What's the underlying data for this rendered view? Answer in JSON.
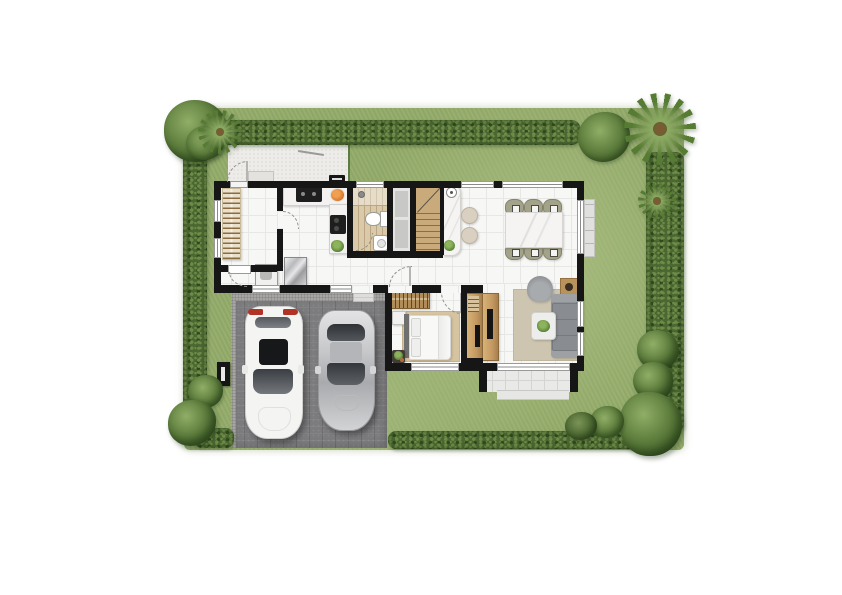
{
  "meta": {
    "type": "architectural site / floor plan, top-down render",
    "visible_text": [],
    "description": "Single-storey house plan on a lawned plot bordered by hedges and trees; back patio top-left, carport with two cars bottom-left, terrace with step bottom-right."
  },
  "palette": {
    "lawn": "#93ab6a",
    "lawn_light": "#a9bd80",
    "hedge": "#4c6832",
    "hedge_light": "#6e8c48",
    "hedge_dark": "#31491d",
    "tree": "#5d7d3d",
    "tree_light": "#90ae66",
    "tree_dark": "#3c5a26",
    "palm": "#567b33",
    "palm_dark": "#7a5c33",
    "wall": "#161616",
    "floor": "#f7f7f6",
    "tile": "#e7e7e5",
    "wood_floor": "#dbcaa9",
    "stair_wood": "#c9aa7b",
    "stair_tread": "#8a6d45",
    "patio": "#edece8",
    "terrace": "#e9e9e7",
    "terrace_line": "#d4d4d2",
    "driveway": "#7c7c7e",
    "gravel": "#a6a5a3",
    "counter": "#f3f2f0",
    "appliance": "#1e1e1e",
    "cabinet_wood": "#c49a62",
    "wardrobe": "#b08c58",
    "tv": "#141414",
    "chair_olive": "#a2a389",
    "stool": "#d9d0c1",
    "sofa": "#8f9296",
    "sofa_dark": "#7c8084",
    "rug_living": "#cdc5b0",
    "rug_bed": "#d6c3a0",
    "bed": "#f8f8f7",
    "headboard": "#6f6f6f",
    "plant": "#5f8b3f",
    "pot": "#b06a42",
    "fruit": "#d8742c",
    "car_white": "#f4f4f3",
    "car_red": "#b33226",
    "car_silver": "#c6c7c9",
    "glass": "#3a3e43",
    "window": "#ffffff",
    "sill": "#e0e0de",
    "marble_table": "#f5f4f2"
  },
  "scene": {
    "plot": {
      "ground": "lawn",
      "boundaries": [
        "hedge-top",
        "hedge-left",
        "hedge-right",
        "hedge-bottom"
      ],
      "hardscape": [
        "back-patio-concrete",
        "carport-paver-driveway",
        "terrace-with-step"
      ],
      "vegetation": [
        "corner-tree-top-left",
        "palm-top-left",
        "bush-top-right",
        "palm-top-right-corner",
        "palm-right-side",
        "round-tree-right",
        "tree-right-lower",
        "large-tree-bottom-right",
        "bush-bottom-right",
        "dark-bush-bottom-right",
        "bush-bottom-left",
        "large-bush-bottom-left"
      ]
    },
    "house": {
      "rooms": [
        {
          "name": "utility-room",
          "furniture": [
            "slatted-shelf-rack",
            "washing-machine",
            "door-to-patio",
            "door-to-kitchen",
            "service-door"
          ]
        },
        {
          "name": "kitchen",
          "furniture": [
            "l-shaped-counter",
            "double-sink-unit",
            "fruit-bowl",
            "cooktop",
            "counter-plant",
            "refrigerator"
          ]
        },
        {
          "name": "bathroom",
          "furniture": [
            "shower-area",
            "toilet",
            "wash-basin",
            "swing-door"
          ],
          "floor": "wood-plank"
        },
        {
          "name": "staircase",
          "furniture": [
            "wood-treads",
            "up-direction-line",
            "side-closet-strip"
          ]
        },
        {
          "name": "bar",
          "furniture": [
            "marble-bar-counter",
            "bar-sink",
            "bar-plant",
            "two-round-stools"
          ]
        },
        {
          "name": "dining-room",
          "furniture": [
            "marble-dining-table",
            "six-olive-chairs"
          ]
        },
        {
          "name": "hallway",
          "furniture": [
            "front-door-swing",
            "carport-doorway-steps"
          ]
        },
        {
          "name": "bedroom",
          "furniture": [
            "wardrobe-hanging-clothes",
            "double-bed",
            "two-pillows",
            "nightstand",
            "bench-with-plant",
            "area-rug",
            "tv-cabinet"
          ]
        },
        {
          "name": "living-room",
          "furniture": [
            "three-seat-sofa",
            "armchair",
            "coffee-table-with-plant",
            "side-table-lamp",
            "area-rug",
            "tv-cabinet"
          ]
        },
        {
          "name": "terrace",
          "furniture": [
            "tiled-deck",
            "entry-step"
          ]
        }
      ],
      "exterior_fixtures": [
        "ac-condenser-unit",
        "utility-meter-box",
        "clothesline-post",
        "back-door-step",
        "dining-window-sill"
      ]
    },
    "vehicles": [
      {
        "name": "suv",
        "color": "white",
        "details": [
          "red-taillights",
          "black-sunroof",
          "dark-windshield",
          "side-mirrors"
        ]
      },
      {
        "name": "coupe",
        "color": "silver",
        "details": [
          "dark-rear-glass",
          "dark-windshield",
          "side-mirrors"
        ]
      }
    ]
  }
}
